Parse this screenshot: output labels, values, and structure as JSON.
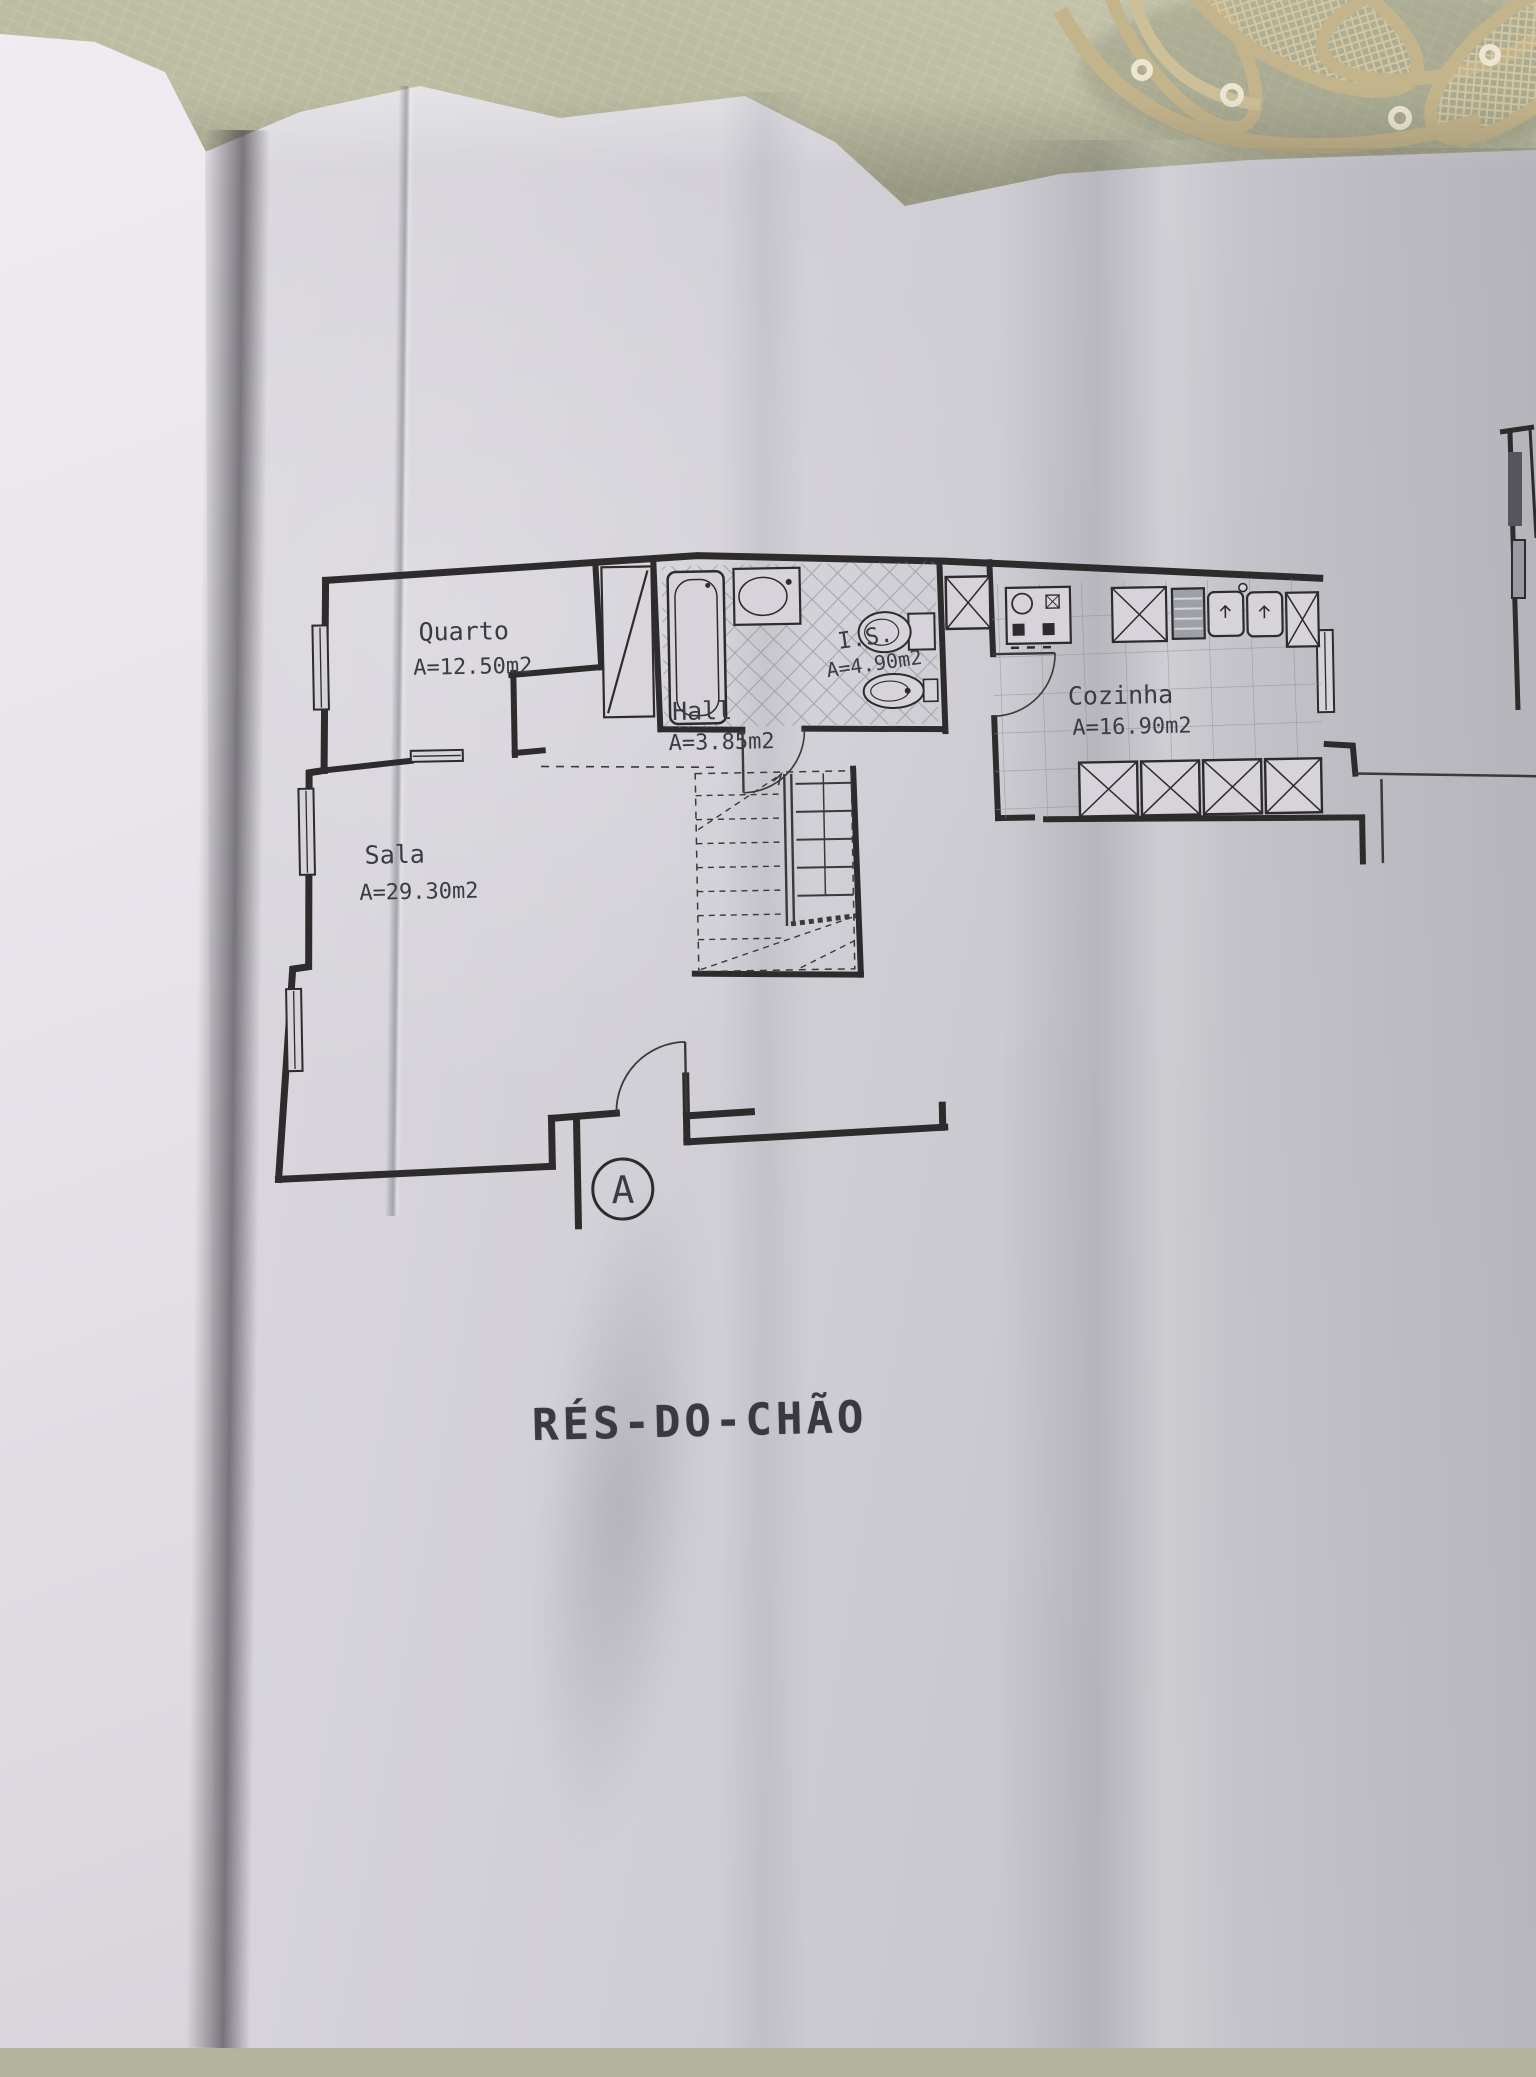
{
  "floor_plan": {
    "title": "RÉS-DO-CHÃO",
    "section_marker": "A",
    "rooms": [
      {
        "name": "Quarto",
        "area": "A=12.50m2"
      },
      {
        "name": "Sala",
        "area": "A=29.30m2"
      },
      {
        "name": "Hall",
        "area": "A=3.85m2"
      },
      {
        "name": "I.S.",
        "area": "A=4.90m2"
      },
      {
        "name": "Cozinha",
        "area": "A=16.90m2"
      }
    ]
  },
  "colors": {
    "tablecloth": "#b3b49b",
    "lace": "#c5b78e",
    "paper_sheet": "#d4d2d8",
    "left_page": "#e9e7ec",
    "ink": "#2d2b2b",
    "tile_line": "#8d9298"
  }
}
